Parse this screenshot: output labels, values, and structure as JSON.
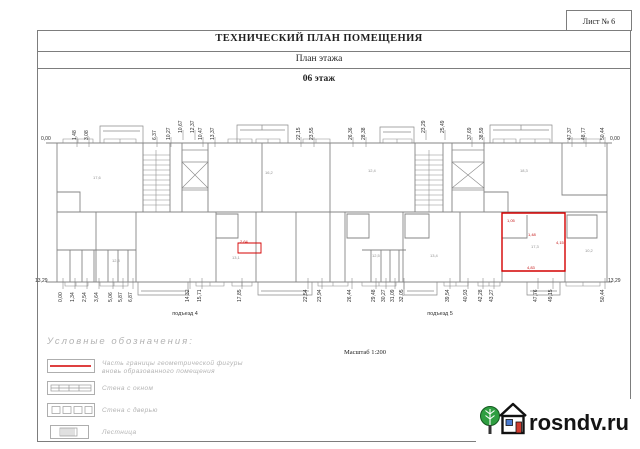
{
  "sheet": {
    "number": "Лист №  6"
  },
  "header": {
    "title": "ТЕХНИЧЕСКИЙ ПЛАН ПОМЕЩЕНИЯ",
    "subtitle": "План  этажа",
    "floor": "06 этаж"
  },
  "plan": {
    "scale": "Масштаб 1:200",
    "entrances": {
      "left": "подъезд 4",
      "right": "подъезд 5"
    },
    "elevations": {
      "top_left": "0,00",
      "top_right": "0,00",
      "bottom_left": "13,29",
      "bottom_right": "13,29"
    },
    "highlight_color": "#d40000",
    "top_dims": [
      {
        "label": "1,48",
        "x": 72,
        "y": 140
      },
      {
        "label": "3,08",
        "x": 84,
        "y": 140
      },
      {
        "label": "6,37",
        "x": 152,
        "y": 140
      },
      {
        "label": "10,27",
        "x": 166,
        "y": 140
      },
      {
        "label": "10,67",
        "x": 178,
        "y": 133
      },
      {
        "label": "12,37",
        "x": 190,
        "y": 133
      },
      {
        "label": "10,47",
        "x": 198,
        "y": 140
      },
      {
        "label": "13,37",
        "x": 210,
        "y": 140
      },
      {
        "label": "22,15",
        "x": 296,
        "y": 140
      },
      {
        "label": "23,55",
        "x": 309,
        "y": 140
      },
      {
        "label": "26,36",
        "x": 348,
        "y": 140
      },
      {
        "label": "28,38",
        "x": 361,
        "y": 140
      },
      {
        "label": "23,29",
        "x": 421,
        "y": 133
      },
      {
        "label": "25,49",
        "x": 440,
        "y": 133
      },
      {
        "label": "37,69",
        "x": 467,
        "y": 140
      },
      {
        "label": "38,59",
        "x": 479,
        "y": 140
      },
      {
        "label": "47,37",
        "x": 567,
        "y": 140
      },
      {
        "label": "48,77",
        "x": 581,
        "y": 140
      },
      {
        "label": "50,44",
        "x": 600,
        "y": 140
      }
    ],
    "bottom_dims": [
      {
        "label": "0,00",
        "x": 58,
        "y": 302
      },
      {
        "label": "1,34",
        "x": 70,
        "y": 302
      },
      {
        "label": "2,54",
        "x": 82,
        "y": 302
      },
      {
        "label": "3,64",
        "x": 94,
        "y": 302
      },
      {
        "label": "5,06",
        "x": 108,
        "y": 302
      },
      {
        "label": "5,87",
        "x": 118,
        "y": 302
      },
      {
        "label": "6,87",
        "x": 128,
        "y": 302
      },
      {
        "label": "14,32",
        "x": 185,
        "y": 302
      },
      {
        "label": "15,71",
        "x": 197,
        "y": 302
      },
      {
        "label": "17,85",
        "x": 237,
        "y": 302
      },
      {
        "label": "22,54",
        "x": 303,
        "y": 302
      },
      {
        "label": "23,94",
        "x": 317,
        "y": 302
      },
      {
        "label": "26,44",
        "x": 347,
        "y": 302
      },
      {
        "label": "29,48",
        "x": 371,
        "y": 302
      },
      {
        "label": "30,27",
        "x": 381,
        "y": 302
      },
      {
        "label": "31,09",
        "x": 390,
        "y": 302
      },
      {
        "label": "32,05",
        "x": 399,
        "y": 302
      },
      {
        "label": "39,54",
        "x": 445,
        "y": 302
      },
      {
        "label": "40,93",
        "x": 463,
        "y": 302
      },
      {
        "label": "42,28",
        "x": 478,
        "y": 302
      },
      {
        "label": "43,27",
        "x": 489,
        "y": 302
      },
      {
        "label": "47,76",
        "x": 533,
        "y": 302
      },
      {
        "label": "49,15",
        "x": 548,
        "y": 302
      },
      {
        "label": "50,44",
        "x": 600,
        "y": 302
      }
    ],
    "red_dims": [
      {
        "label": "2,64",
        "x": 240,
        "y": 239
      },
      {
        "label": "1,05",
        "x": 507,
        "y": 218
      },
      {
        "label": "1,48",
        "x": 528,
        "y": 232
      },
      {
        "label": "4,15",
        "x": 556,
        "y": 240
      },
      {
        "label": "4,83",
        "x": 527,
        "y": 265
      }
    ],
    "room_labels": [
      {
        "label": "17,6",
        "x": 93,
        "y": 175
      },
      {
        "label": "16,2",
        "x": 265,
        "y": 170
      },
      {
        "label": "12,4",
        "x": 368,
        "y": 168
      },
      {
        "label": "18,3",
        "x": 520,
        "y": 168
      },
      {
        "label": "12,8",
        "x": 112,
        "y": 258
      },
      {
        "label": "13,1",
        "x": 232,
        "y": 255
      },
      {
        "label": "12,5",
        "x": 372,
        "y": 253
      },
      {
        "label": "13,4",
        "x": 430,
        "y": 253
      },
      {
        "label": "17,3",
        "x": 531,
        "y": 244
      },
      {
        "label": "10,2",
        "x": 585,
        "y": 248
      }
    ]
  },
  "legend": {
    "title": "Условные  обозначения:",
    "items": [
      {
        "line1": "Часть границы геометрической фигуры",
        "line2": "вновь образованного помещения"
      },
      {
        "line1": "Стена с  окном",
        "line2": ""
      },
      {
        "line1": "Стена с   дверью",
        "line2": ""
      },
      {
        "line1": "Лестница",
        "line2": ""
      }
    ]
  },
  "watermark": {
    "text": "rosndv.ru"
  }
}
